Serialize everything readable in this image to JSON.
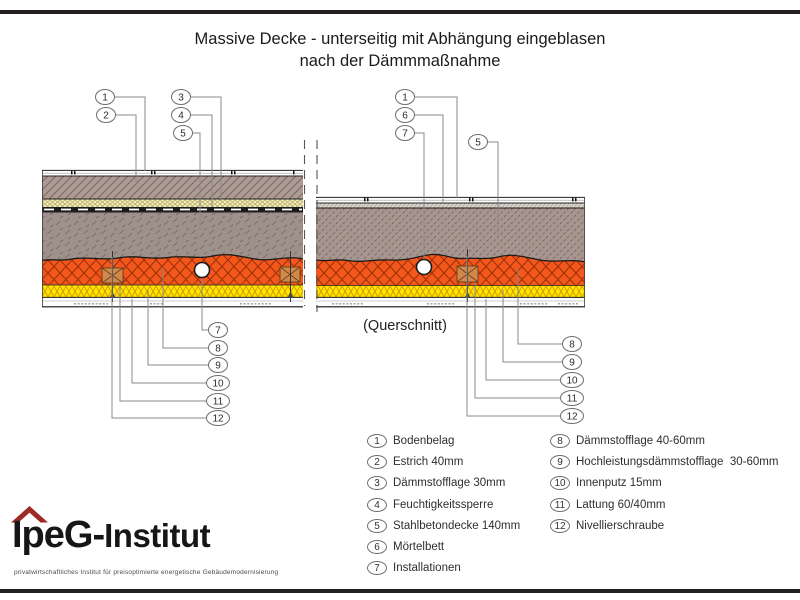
{
  "title": {
    "line1": "Massive Decke - unterseitig mit Abhängung eingeblasen",
    "line2": "nach der Dämmmaßnahme"
  },
  "diagram": {
    "querschnitt_label": "(Querschnitt)",
    "left_section": {
      "callouts_top": [
        "1",
        "2",
        "3",
        "4",
        "5"
      ],
      "callouts_bottom": [
        "7",
        "8",
        "9",
        "10",
        "11",
        "12"
      ]
    },
    "right_section": {
      "callouts_top": [
        "1",
        "6",
        "7",
        "5"
      ],
      "callouts_bottom": [
        "8",
        "9",
        "10",
        "11",
        "12"
      ]
    }
  },
  "legend": {
    "column1": [
      {
        "num": "1",
        "label": "Bodenbelag"
      },
      {
        "num": "2",
        "label": "Estrich 40mm"
      },
      {
        "num": "3",
        "label": "Dämmstofflage 30mm"
      },
      {
        "num": "4",
        "label": "Feuchtigkeitssperre"
      },
      {
        "num": "5",
        "label": "Stahlbetondecke 140mm"
      },
      {
        "num": "6",
        "label": "Mörtelbett"
      },
      {
        "num": "7",
        "label": "Installationen"
      }
    ],
    "column2": [
      {
        "num": "8",
        "label": "Dämmstofflage 40-60mm"
      },
      {
        "num": "9",
        "label": "Hochleistungsdämmstofflage  30-60mm"
      },
      {
        "num": "10",
        "label": "Innenputz 15mm"
      },
      {
        "num": "11",
        "label": "Lattung 60/40mm"
      },
      {
        "num": "12",
        "label": "Nivellierschraube"
      }
    ]
  },
  "logo": {
    "name_main": "IpeG-",
    "name_sub": "Institut",
    "tagline": "privatwirtschaftliches Institut für preisoptimierte energetische Gebäudemodernisierung"
  },
  "colors": {
    "frame_bar": "#231f20",
    "estrich": "#ac9b94",
    "concrete_left": "#9e918b",
    "concrete_right": "#a79690",
    "insulation_pale": "#f2eec0",
    "membrane": "#1c1c1c",
    "mortar": "#d7d0c9",
    "insulation_orange": "#f4571c",
    "insulation_yellow": "#ffe600",
    "batten": "#d1894b",
    "logo_roof": "#9e2a25"
  }
}
